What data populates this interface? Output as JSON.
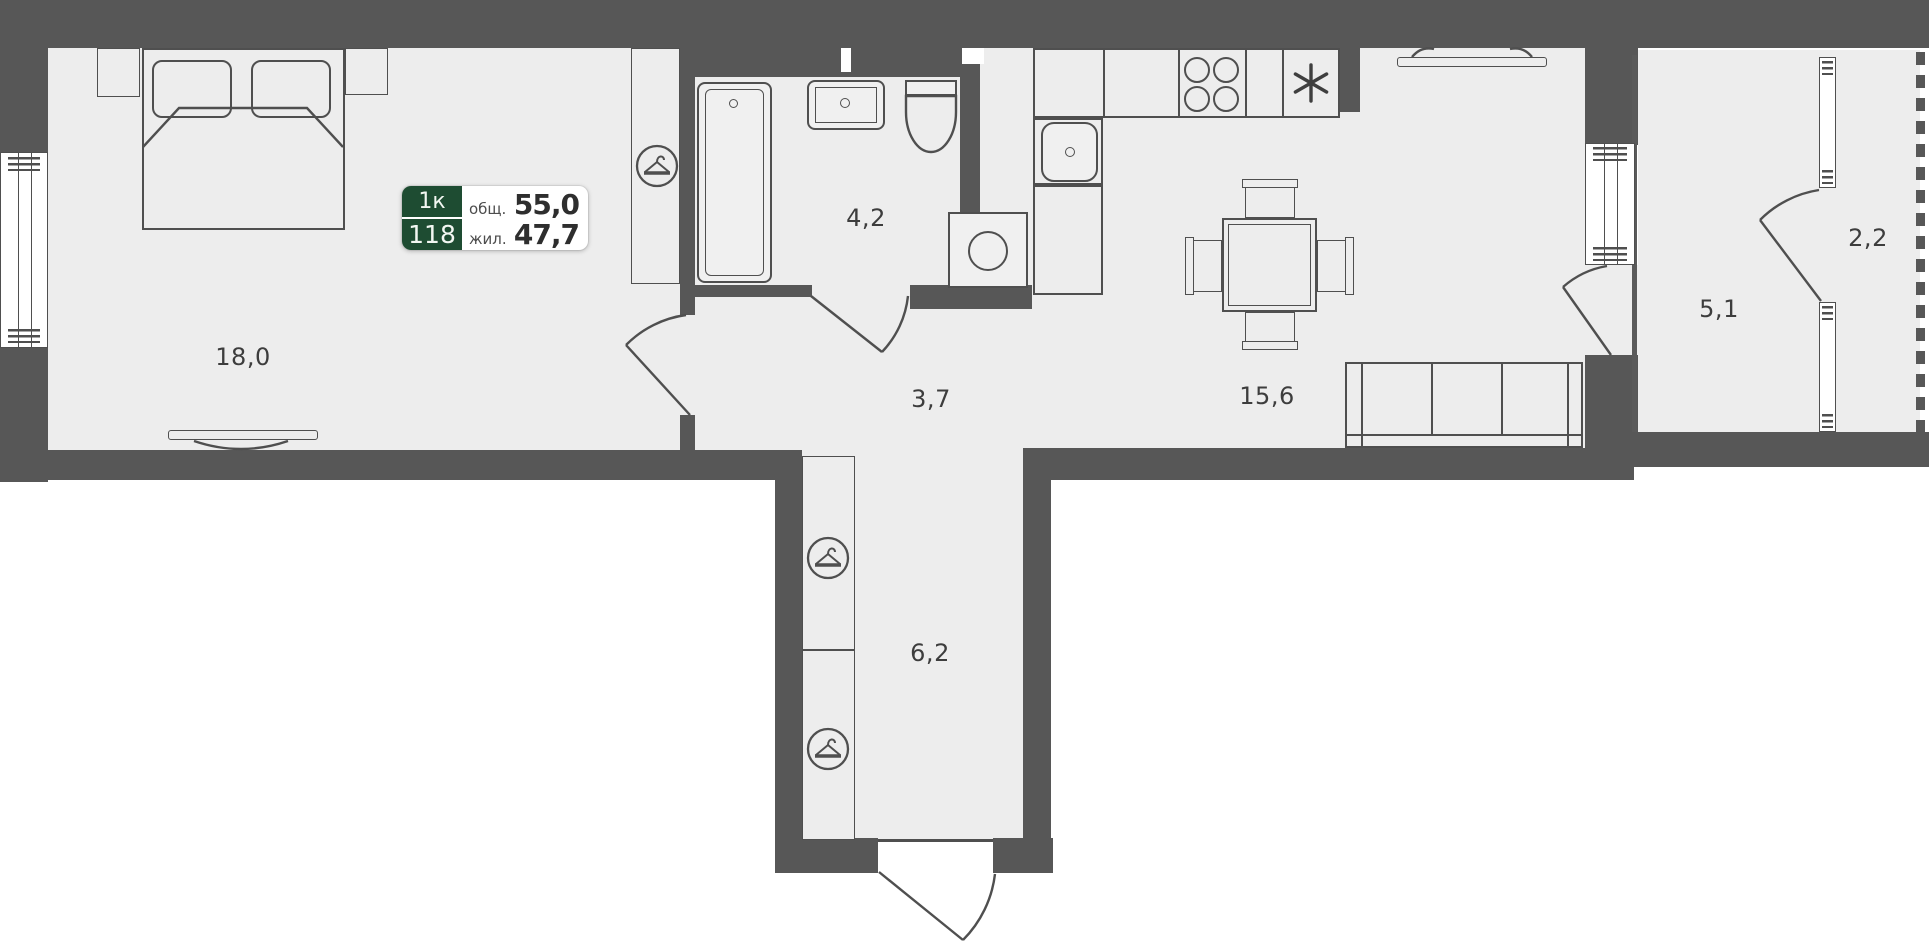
{
  "plan": {
    "badge": {
      "room_type": "1к",
      "unit_number": "118",
      "total_label": "общ.",
      "total_area": "55,0",
      "living_label": "жил.",
      "living_area": "47,7"
    },
    "rooms": [
      {
        "name": "bedroom",
        "area": "18,0"
      },
      {
        "name": "bathroom",
        "area": "4,2"
      },
      {
        "name": "hallway",
        "area": "3,7"
      },
      {
        "name": "kitchen-living",
        "area": "15,6"
      },
      {
        "name": "corridor",
        "area": "6,2"
      },
      {
        "name": "loggia",
        "area": "5,1"
      },
      {
        "name": "loggia-2",
        "area": "2,2"
      }
    ],
    "icons": {
      "wardrobe": "hanger-icon",
      "stove": "burner-icons",
      "appliance": "asterisk-icon"
    },
    "colors": {
      "wall": "#575757",
      "floor": "#ededed",
      "line": "#4f4f4f",
      "badge_green": "#1e4c32",
      "label_text": "#3d3d3d"
    }
  }
}
